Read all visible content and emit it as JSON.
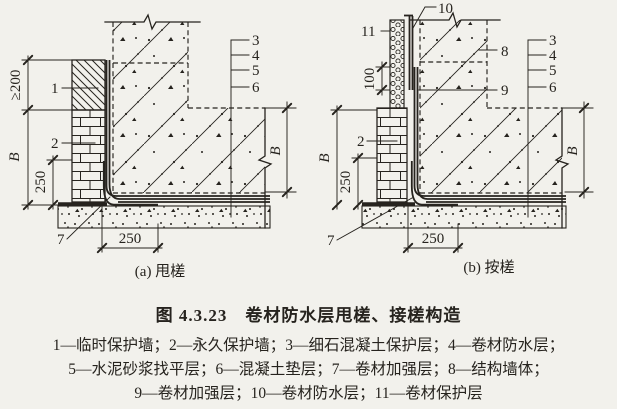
{
  "colors": {
    "ink": "#26231e",
    "paper": "#f2f1ec"
  },
  "figure_caption": {
    "title": "图 4.3.23　卷材防水层甩槎、接槎构造",
    "legend": [
      "1—临时保护墙；2—永久保护墙；3—细石混凝土保护层；4—卷材防水层；",
      "5—水泥砂浆找平层；6—混凝土垫层；7—卷材加强层；8—结构墙体；",
      "9—卷材加强层；10—卷材防水层；11—卷材保护层"
    ]
  },
  "diagram_a": {
    "caption": "(a) 甩槎",
    "callouts": {
      "c1": "1",
      "c2": "2",
      "c3": "3",
      "c4": "4",
      "c5": "5",
      "c6": "6",
      "c7": "7"
    },
    "dims": {
      "top_height": "≥200",
      "wall_height": "B",
      "corner_up": "250",
      "slab_depth": "B",
      "corner_run": "250"
    }
  },
  "diagram_b": {
    "caption": "(b) 按槎",
    "callouts": {
      "c2": "2",
      "c3": "3",
      "c4": "4",
      "c5": "5",
      "c6": "6",
      "c7": "7",
      "c8": "8",
      "c9": "9",
      "c10": "10",
      "c11": "11"
    },
    "dims": {
      "lap": "100",
      "wall_height": "B",
      "corner_up": "250",
      "slab_depth": "B",
      "corner_run": "250"
    }
  }
}
